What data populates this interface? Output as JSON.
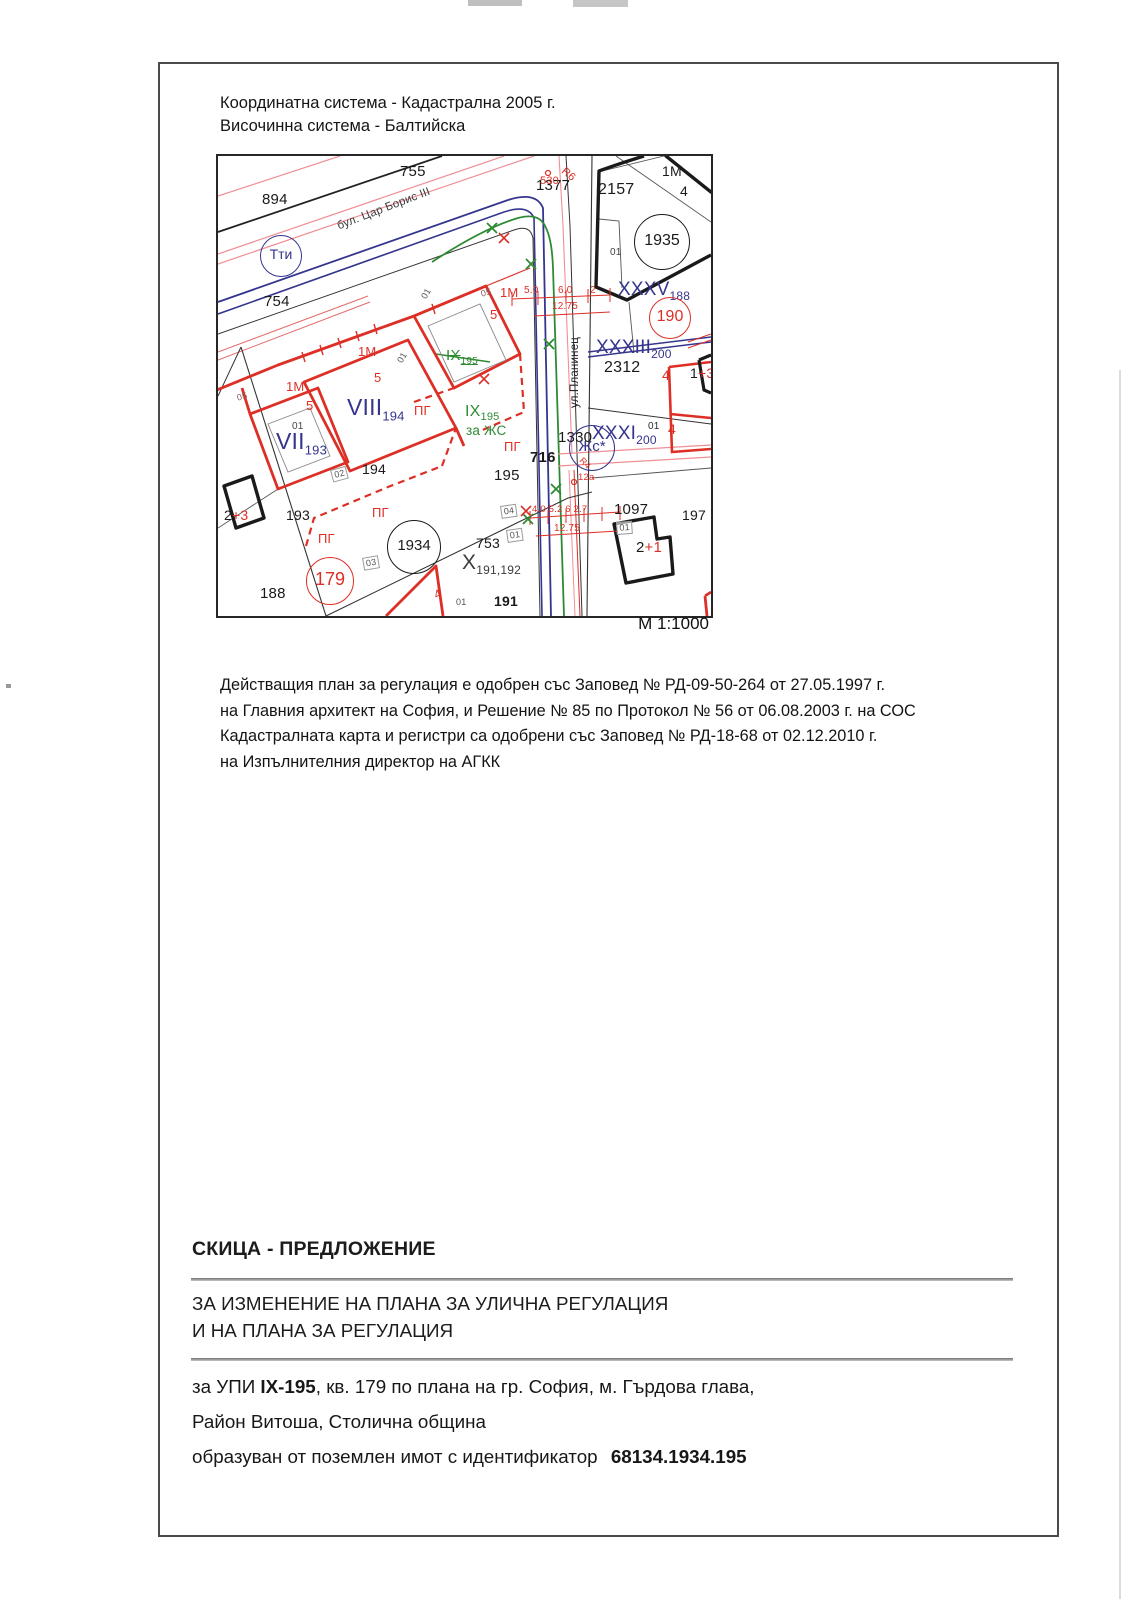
{
  "page": {
    "header": {
      "line1": "Координатна система - Кадастрална 2005 г.",
      "line2": "Височинна система - Балтийска"
    },
    "scale_label": "М 1:1000",
    "paragraph": [
      "Действащия план за регулация е одобрен със Заповед № РД-09-50-264 от 27.05.1997 г.",
      "на Главния архитект на София, и  Решение № 85 по Протокол № 56 от 06.08.2003 г. на СОС",
      "Кадастралната карта и регистри са одобрени със Заповед № РД-18-68 от 02.12.2010 г.",
      "на Изпълнителния директор на АГКК"
    ],
    "footer": {
      "title": "СКИЦА - ПРЕДЛОЖЕНИЕ",
      "subtitle_line1": "ЗА ИЗМЕНЕНИЕ НА ПЛАНА ЗА УЛИЧНА РЕГУЛАЦИЯ",
      "subtitle_line2": "И НА ПЛАНА ЗА РЕГУЛАЦИЯ",
      "detail1_prefix": "за УПИ ",
      "detail1_bold": "IX-195",
      "detail1_suffix": ", кв. 179 по плана на гр. София, м. Гърдова глава,",
      "detail2": "Район Витоша, Столична община",
      "detail3_prefix": "образуван от поземлен имот с идентификатор ",
      "detail3_bold": "68134.1934.195"
    }
  },
  "colors": {
    "regulation_red": "#dd2f26",
    "cadastre_blue": "#35358e",
    "proposal_green": "#2e8b34",
    "old_plan_pink": "#ef8f96",
    "ink_black": "#1a1a1a"
  },
  "map": {
    "labels": [
      {
        "n": "parcel-755",
        "t": "755",
        "x": 182,
        "y": 8,
        "s": 15
      },
      {
        "n": "parcel-894",
        "t": "894",
        "x": 44,
        "y": 36,
        "s": 15
      },
      {
        "n": "parcel-754",
        "t": "754",
        "x": 46,
        "y": 138,
        "s": 15
      },
      {
        "n": "point-1377",
        "t": "1377",
        "x": 318,
        "y": 22,
        "s": 15
      },
      {
        "n": "parcel-2157",
        "t": "2157",
        "x": 380,
        "y": 26,
        "s": 16
      },
      {
        "n": "label-1m-topright",
        "t": "1М",
        "x": 444,
        "y": 8,
        "s": 14
      },
      {
        "n": "label-4-topright",
        "t": "4",
        "x": 462,
        "y": 28,
        "s": 14
      },
      {
        "n": "label-01",
        "t": "01",
        "x": 392,
        "y": 92,
        "s": 10,
        "c": "#444444"
      },
      {
        "n": "parcel-2312",
        "t": "2312",
        "x": 386,
        "y": 204,
        "s": 16
      },
      {
        "n": "point-1330",
        "t": "1330",
        "x": 340,
        "y": 274,
        "s": 15
      },
      {
        "n": "point-716",
        "t": "716",
        "x": 312,
        "y": 294,
        "s": 15,
        "b": true
      },
      {
        "n": "parcel-195",
        "t": "195",
        "x": 276,
        "y": 312,
        "s": 15
      },
      {
        "n": "parcel-194",
        "t": "194",
        "x": 144,
        "y": 306,
        "s": 14
      },
      {
        "n": "parcel-193",
        "t": "193",
        "x": 68,
        "y": 352,
        "s": 14
      },
      {
        "n": "parcel-188",
        "t": "188",
        "x": 42,
        "y": 430,
        "s": 15
      },
      {
        "n": "parcel-753",
        "t": "753",
        "x": 258,
        "y": 380,
        "s": 14
      },
      {
        "n": "parcel-191",
        "t": "191",
        "x": 276,
        "y": 438,
        "s": 14,
        "b": true
      },
      {
        "n": "parcel-1097",
        "t": "1097",
        "x": 396,
        "y": 346,
        "s": 15
      },
      {
        "n": "parcel-197",
        "t": "197",
        "x": 464,
        "y": 352,
        "s": 14
      },
      {
        "n": "parcel-x-191-192",
        "t": "X",
        "sub": "191,192",
        "x": 244,
        "y": 396,
        "s": 21,
        "ss": 12,
        "c": "#3c3c3c"
      },
      {
        "n": "label-01",
        "t": "01",
        "x": 74,
        "y": 266,
        "s": 10,
        "c": "#454545"
      },
      {
        "n": "label-01-rotated",
        "t": "01",
        "x": 178,
        "y": 204,
        "s": 9,
        "r": -60,
        "c": "#555555"
      },
      {
        "n": "label-01-rotated",
        "t": "01",
        "x": 202,
        "y": 140,
        "s": 9,
        "r": -60,
        "c": "#555555"
      },
      {
        "n": "label-01",
        "t": "01",
        "x": 430,
        "y": 266,
        "s": 10,
        "c": "#2a2a2a"
      },
      {
        "n": "label-01",
        "t": "01",
        "x": 238,
        "y": 442,
        "s": 9,
        "c": "#555555"
      },
      {
        "n": "label-01-boxed",
        "t": "01",
        "x": 398,
        "y": 366,
        "s": 9,
        "c": "#555555",
        "box": true,
        "r": -4
      },
      {
        "n": "label-04-boxed",
        "t": "04",
        "x": 282,
        "y": 350,
        "s": 9,
        "c": "#555555",
        "box": true,
        "r": -8
      },
      {
        "n": "label-01-boxed",
        "t": "01",
        "x": 288,
        "y": 374,
        "s": 9,
        "c": "#555555",
        "box": true,
        "r": -8
      },
      {
        "n": "label-02-boxed",
        "t": "02",
        "x": 112,
        "y": 314,
        "s": 9,
        "c": "#555555",
        "box": true,
        "r": -15
      },
      {
        "n": "label-03-boxed",
        "t": "03",
        "x": 144,
        "y": 402,
        "s": 9,
        "c": "#555555",
        "box": true,
        "r": -10
      },
      {
        "n": "label-05",
        "t": "05",
        "x": 18,
        "y": 238,
        "s": 9,
        "c": "#8a6060",
        "r": -15
      },
      {
        "n": "label-05",
        "t": "05",
        "x": 262,
        "y": 134,
        "s": 9,
        "c": "#8a6060",
        "r": -15
      },
      {
        "n": "label-1m-red",
        "t": "1М",
        "x": 140,
        "y": 189,
        "s": 13,
        "c": "#dd2f26"
      },
      {
        "n": "label-1m-red",
        "t": "1М",
        "x": 68,
        "y": 224,
        "s": 13,
        "c": "#dd2f26"
      },
      {
        "n": "label-1m-red",
        "t": "1М",
        "x": 282,
        "y": 130,
        "s": 13,
        "c": "#dd2f26"
      },
      {
        "n": "label-5-red",
        "t": "5",
        "x": 88,
        "y": 243,
        "s": 13,
        "c": "#dd2f26"
      },
      {
        "n": "label-5-red",
        "t": "5",
        "x": 156,
        "y": 215,
        "s": 13,
        "c": "#dd2f26"
      },
      {
        "n": "label-5-red",
        "t": "5",
        "x": 272,
        "y": 152,
        "s": 13,
        "c": "#dd2f26"
      },
      {
        "n": "point-530",
        "t": "530",
        "x": 322,
        "y": 20,
        "s": 11,
        "c": "#dd2f26"
      },
      {
        "n": "radius-r6",
        "t": "R6",
        "x": 348,
        "y": 10,
        "s": 11,
        "c": "#dd2f26",
        "r": 40
      },
      {
        "n": "radius-r4",
        "t": "R4",
        "x": 366,
        "y": 300,
        "s": 9,
        "c": "#dd2f26",
        "r": 45
      },
      {
        "n": "dim-5-0",
        "t": "5.0",
        "x": 306,
        "y": 130,
        "s": 10,
        "c": "#dd2f26"
      },
      {
        "n": "dim-6-0",
        "t": "6.0",
        "x": 340,
        "y": 130,
        "s": 10,
        "c": "#dd2f26"
      },
      {
        "n": "dim-2",
        "t": "2",
        "x": 372,
        "y": 130,
        "s": 10,
        "c": "#dd2f26"
      },
      {
        "n": "dim-12-75",
        "t": "12.75",
        "x": 334,
        "y": 146,
        "s": 10,
        "c": "#dd2f26"
      },
      {
        "n": "dim-chain",
        "t": "4.0 5.2 6 2.7",
        "x": 314,
        "y": 349,
        "s": 9.5,
        "c": "#dd2f26"
      },
      {
        "n": "dim-12-75",
        "t": "12.75",
        "x": 336,
        "y": 368,
        "s": 10,
        "c": "#dd2f26"
      },
      {
        "n": "point-12a",
        "t": "12a",
        "x": 360,
        "y": 317,
        "s": 9.5,
        "c": "#dd2f26"
      },
      {
        "n": "label-pg",
        "t": "ПГ",
        "x": 196,
        "y": 248,
        "s": 13,
        "c": "#dd2f26"
      },
      {
        "n": "label-pg",
        "t": "ПГ",
        "x": 286,
        "y": 284,
        "s": 13,
        "c": "#dd2f26"
      },
      {
        "n": "label-pg",
        "t": "ПГ",
        "x": 154,
        "y": 350,
        "s": 13,
        "c": "#dd2f26"
      },
      {
        "n": "label-pg",
        "t": "ПГ",
        "x": 100,
        "y": 376,
        "s": 13,
        "c": "#dd2f26"
      },
      {
        "n": "label-4-red",
        "t": "4",
        "x": 444,
        "y": 212,
        "s": 14,
        "c": "#dd2f26"
      },
      {
        "n": "label-4-red",
        "t": "4",
        "x": 450,
        "y": 266,
        "s": 14,
        "c": "#dd2f26"
      },
      {
        "n": "label-4-red",
        "t": "4",
        "x": 214,
        "y": 434,
        "s": 12,
        "c": "#dd2f26",
        "r": -25
      },
      {
        "n": "building-2-3",
        "parts": [
          [
            "2",
            "#1a1a1a"
          ],
          [
            "+3",
            "#dd2f26"
          ]
        ],
        "x": 6,
        "y": 352,
        "s": 14
      },
      {
        "n": "building-2-1",
        "parts": [
          [
            "2",
            "#1a1a1a"
          ],
          [
            "+1",
            "#dd2f26"
          ]
        ],
        "x": 418,
        "y": 384,
        "s": 15
      },
      {
        "n": "building-1-3",
        "parts": [
          [
            "1",
            "#1a1a1a"
          ],
          [
            "+3",
            "#dd2f26"
          ]
        ],
        "x": 472,
        "y": 210,
        "s": 14
      },
      {
        "n": "upi-viii-194",
        "t": "VIII",
        "sub": "194",
        "x": 129,
        "y": 240,
        "s": 23,
        "ss": 13,
        "c": "#35358e"
      },
      {
        "n": "upi-vii-193",
        "t": "VII",
        "sub": "193",
        "x": 58,
        "y": 274,
        "s": 23,
        "ss": 13,
        "c": "#35358e"
      },
      {
        "n": "upi-xxxv-188",
        "t": "XXXV",
        "sub": "188",
        "x": 400,
        "y": 124,
        "s": 19,
        "ss": 12,
        "c": "#35358e"
      },
      {
        "n": "upi-xxxiii-200",
        "t": "XXXIII",
        "sub": "200",
        "x": 378,
        "y": 182,
        "s": 19,
        "ss": 12,
        "c": "#35358e"
      },
      {
        "n": "upi-xxxi-200",
        "t": "XXXI",
        "sub": "200",
        "x": 374,
        "y": 268,
        "s": 19,
        "ss": 12,
        "c": "#35358e"
      },
      {
        "n": "upi-ix-195-old",
        "t": "IX",
        "sub": "195",
        "x": 228,
        "y": 192,
        "s": 15,
        "ss": 10,
        "c": "#2e8b34",
        "strike": true
      },
      {
        "n": "upi-ix-195-new",
        "t": "IX",
        "sub": "195",
        "x": 247,
        "y": 248,
        "s": 16,
        "ss": 11,
        "c": "#2e8b34"
      },
      {
        "n": "label-za-zhs",
        "t": "за ЖС",
        "x": 248,
        "y": 268,
        "s": 13.5,
        "c": "#2e8b34"
      },
      {
        "n": "street-tsar-boris-iii",
        "t": "бул. Цар Борис III",
        "x": 118,
        "y": 66,
        "s": 11.5,
        "c": "#3a3a3a",
        "r": -21
      },
      {
        "n": "street-planinets",
        "t": "ул.Планинец",
        "x": 352,
        "y": 252,
        "s": 11.5,
        "c": "#222222",
        "r": -90
      }
    ],
    "circles": [
      {
        "n": "symbol-tti",
        "t": "Тти",
        "cx": 62,
        "cy": 99,
        "rad": 20,
        "c": "#35358e",
        "s": 14
      },
      {
        "n": "symbol-zhs",
        "t": "Жс*",
        "cx": 373,
        "cy": 291,
        "rad": 22,
        "c": "#35358e",
        "s": 15
      },
      {
        "n": "point-1935",
        "t": "1935",
        "cx": 443,
        "cy": 85,
        "rad": 27,
        "c": "#1a1a1a",
        "s": 16
      },
      {
        "n": "point-1934",
        "t": "1934",
        "cx": 195,
        "cy": 390,
        "rad": 26,
        "c": "#1a1a1a",
        "s": 15
      },
      {
        "n": "kvartal-179",
        "t": "179",
        "cx": 111,
        "cy": 424,
        "rad": 23,
        "c": "#dd2f26",
        "s": 18
      },
      {
        "n": "kvartal-190",
        "t": "190",
        "cx": 451,
        "cy": 161,
        "rad": 20,
        "c": "#dd2f26",
        "s": 16
      }
    ]
  }
}
